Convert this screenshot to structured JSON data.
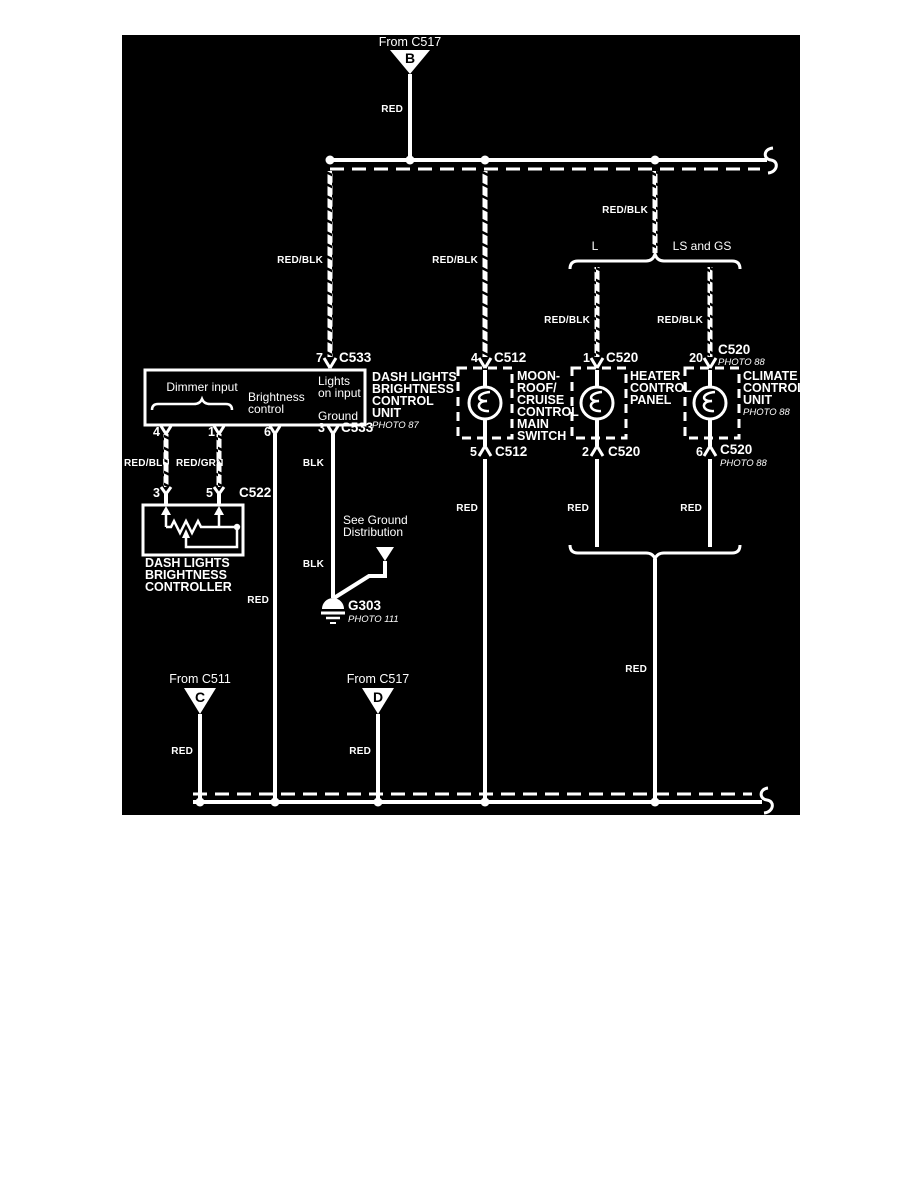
{
  "page": {
    "background": "#ffffff",
    "diagram_background": "#000000",
    "line_color": "#ffffff"
  },
  "colors": {
    "red": "RED",
    "red_blk": "RED/BLK",
    "red_blu": "RED/BLU",
    "red_grn": "RED/GRN",
    "blk": "BLK"
  },
  "sources": {
    "b": {
      "from": "From C517",
      "letter": "B"
    },
    "c": {
      "from": "From C511",
      "letter": "C"
    },
    "d": {
      "from": "From C517",
      "letter": "D"
    }
  },
  "groups": {
    "l": "L",
    "ls_gs": "LS and GS"
  },
  "units": {
    "dlbcu": {
      "top_pin": "7",
      "top_conn": "C533",
      "title": [
        "DASH LIGHTS",
        "BRIGHTNESS",
        "CONTROL",
        "UNIT"
      ],
      "photo": "PHOTO 87",
      "dimmer": "Dimmer input",
      "brightness": [
        "Brightness",
        "control"
      ],
      "lights": [
        "Lights",
        "on input"
      ],
      "ground": "Ground",
      "bottom_pin": "3",
      "bottom_conn": "C533",
      "pin4": "4",
      "pin1": "1",
      "pin6": "6"
    },
    "moonroof": {
      "top_pin": "4",
      "top_conn": "C512",
      "title": [
        "MOON-",
        "ROOF/",
        "CRUISE",
        "CONTROL",
        "MAIN",
        "SWITCH"
      ],
      "bottom_pin": "5",
      "bottom_conn": "C512"
    },
    "heater": {
      "top_pin": "1",
      "top_conn": "C520",
      "title": [
        "HEATER",
        "CONTROL",
        "PANEL"
      ],
      "bottom_pin": "2",
      "bottom_conn": "C520"
    },
    "climate": {
      "top_pin": "20",
      "top_conn": "C520",
      "top_photo": "PHOTO 88",
      "title": [
        "CLIMATE",
        "CONTROL",
        "UNIT"
      ],
      "photo": "PHOTO 88",
      "bottom_pin": "6",
      "bottom_conn": "C520",
      "bottom_photo": "PHOTO 88"
    }
  },
  "c522": {
    "pin3": "3",
    "pin5": "5",
    "conn": "C522"
  },
  "controller": {
    "title": [
      "DASH LIGHTS",
      "BRIGHTNESS",
      "CONTROLLER"
    ]
  },
  "ground_path": {
    "see": [
      "See Ground",
      "Distribution"
    ],
    "g": "G303",
    "photo": "PHOTO 111"
  }
}
